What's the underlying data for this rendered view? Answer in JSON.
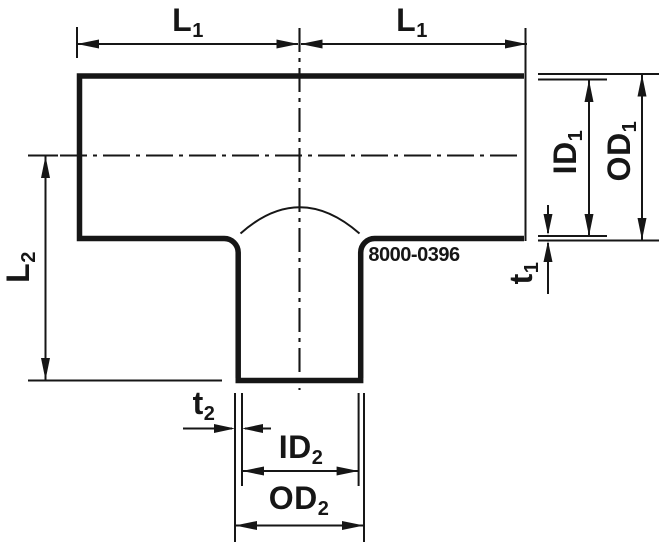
{
  "drawing": {
    "part_number": "8000-0396",
    "labels": {
      "l1_left": {
        "base": "L",
        "sub": "1"
      },
      "l1_right": {
        "base": "L",
        "sub": "1"
      },
      "l2": {
        "base": "L",
        "sub": "2"
      },
      "id1": {
        "base": "ID",
        "sub": "1"
      },
      "od1": {
        "base": "OD",
        "sub": "1"
      },
      "t1": {
        "base": "t",
        "sub": "1"
      },
      "t2": {
        "base": "t",
        "sub": "2"
      },
      "id2": {
        "base": "ID",
        "sub": "2"
      },
      "od2": {
        "base": "OD",
        "sub": "2"
      }
    },
    "colors": {
      "line": "#161616",
      "background": "#ffffff"
    }
  }
}
